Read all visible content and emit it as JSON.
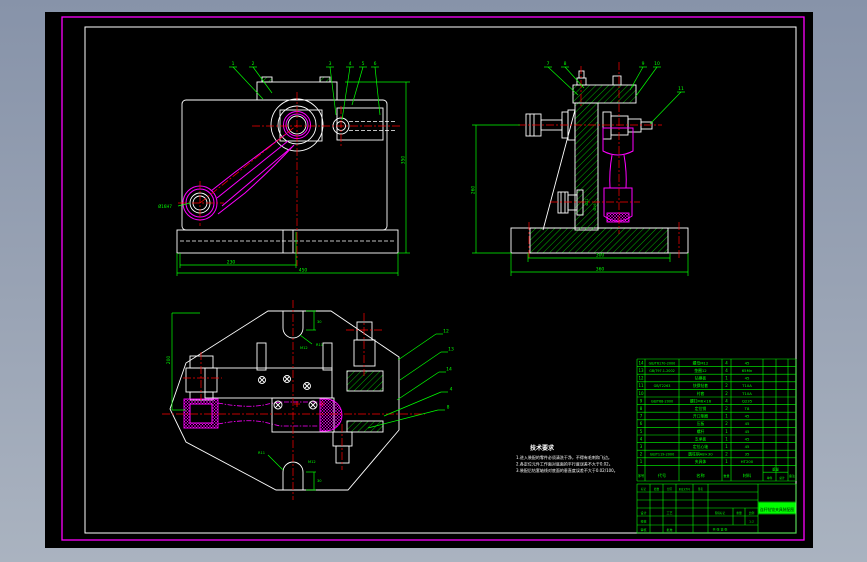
{
  "window": {
    "bg_top": "#8793a9",
    "bg_bottom": "#aab3c0"
  },
  "colors": {
    "canvas": "#000000",
    "paper_frame": "#ff00ff",
    "sheet_frame": "#ffffff",
    "annotation": "#00ff00",
    "centerline": "#ff0000",
    "part_highlight": "#ff00ff"
  },
  "views": {
    "front": {
      "balloons": [
        "1",
        "2",
        "3",
        "4",
        "5",
        "6"
      ],
      "dims": {
        "bottom_inner": "230",
        "bottom_outer": "450",
        "right": "350",
        "small_end": "Ø16H7"
      }
    },
    "side": {
      "balloons": [
        "7",
        "8",
        "9",
        "10",
        "11"
      ],
      "dims": {
        "left": "260",
        "bottom_inner": "300",
        "bottom_outer": "360",
        "mid_a": "Ø22",
        "mid_b": "Ø16"
      }
    },
    "plan": {
      "balloons": [
        "12",
        "13",
        "14",
        "4",
        "8"
      ],
      "dims": {
        "left": "200",
        "top_r": "R11",
        "top_t": "M12",
        "top_w": "30",
        "bot_r": "R11",
        "bot_t": "M12",
        "bot_w": "30"
      }
    }
  },
  "tech_req": {
    "title": "技术要求",
    "items": [
      "1.进入装配的零件必须清洗干净，不得有毛刺和飞边。",
      "2.各定位元件工作面对底面的平行度误差不大于0.02。",
      "3.装配后钻套轴线对底面的垂直度误差不大于0.02/100。"
    ]
  },
  "parts_table": {
    "headers": {
      "no": "序号",
      "code": "代号",
      "name": "名称",
      "qty": "数量",
      "material": "材料",
      "weight": "重量",
      "each": "单件",
      "total": "总计",
      "note": "备注"
    },
    "rows": [
      [
        "14",
        "GB/T6170-2000",
        "螺母M12",
        "4",
        "45",
        "",
        "",
        ""
      ],
      [
        "13",
        "GB/T97.1-2002",
        "垫圈12",
        "4",
        "65Mn",
        "",
        "",
        ""
      ],
      [
        "12",
        "",
        "钻模板",
        "1",
        "45",
        "",
        "",
        ""
      ],
      [
        "11",
        "GB/T2263",
        "快换钻套",
        "2",
        "T10A",
        "",
        "",
        ""
      ],
      [
        "10",
        "",
        "衬套",
        "2",
        "T10A",
        "",
        "",
        ""
      ],
      [
        "9",
        "GB/T68-2000",
        "螺钉M6×16",
        "4",
        "Q235",
        "",
        "",
        ""
      ],
      [
        "8",
        "",
        "定位销",
        "2",
        "T8",
        "",
        "",
        ""
      ],
      [
        "7",
        "",
        "开口垫圈",
        "1",
        "45",
        "",
        "",
        ""
      ],
      [
        "6",
        "",
        "压板",
        "2",
        "45",
        "",
        "",
        ""
      ],
      [
        "5",
        "",
        "螺杆",
        "1",
        "45",
        "",
        "",
        ""
      ],
      [
        "4",
        "",
        "支承板",
        "1",
        "45",
        "",
        "",
        ""
      ],
      [
        "3",
        "",
        "定位心轴",
        "1",
        "45",
        "",
        "",
        ""
      ],
      [
        "2",
        "GB/T119-2000",
        "圆柱销A8×30",
        "2",
        "35",
        "",
        "",
        ""
      ],
      [
        "1",
        "",
        "夹具体",
        "1",
        "HT200",
        "",
        "",
        ""
      ]
    ]
  },
  "title_block": {
    "top_row": [
      "标记",
      "处数",
      "分区",
      "更改文件号",
      "签名"
    ],
    "roles": [
      "设计",
      "校核",
      "审核",
      "工艺",
      "批准"
    ],
    "stage_label": "阶段标记",
    "weight_label": "重量",
    "scale_label": "比例",
    "scale": "1:2",
    "sheets": "共 张 第 张",
    "title": "连杆钻铰夹具装配图"
  }
}
